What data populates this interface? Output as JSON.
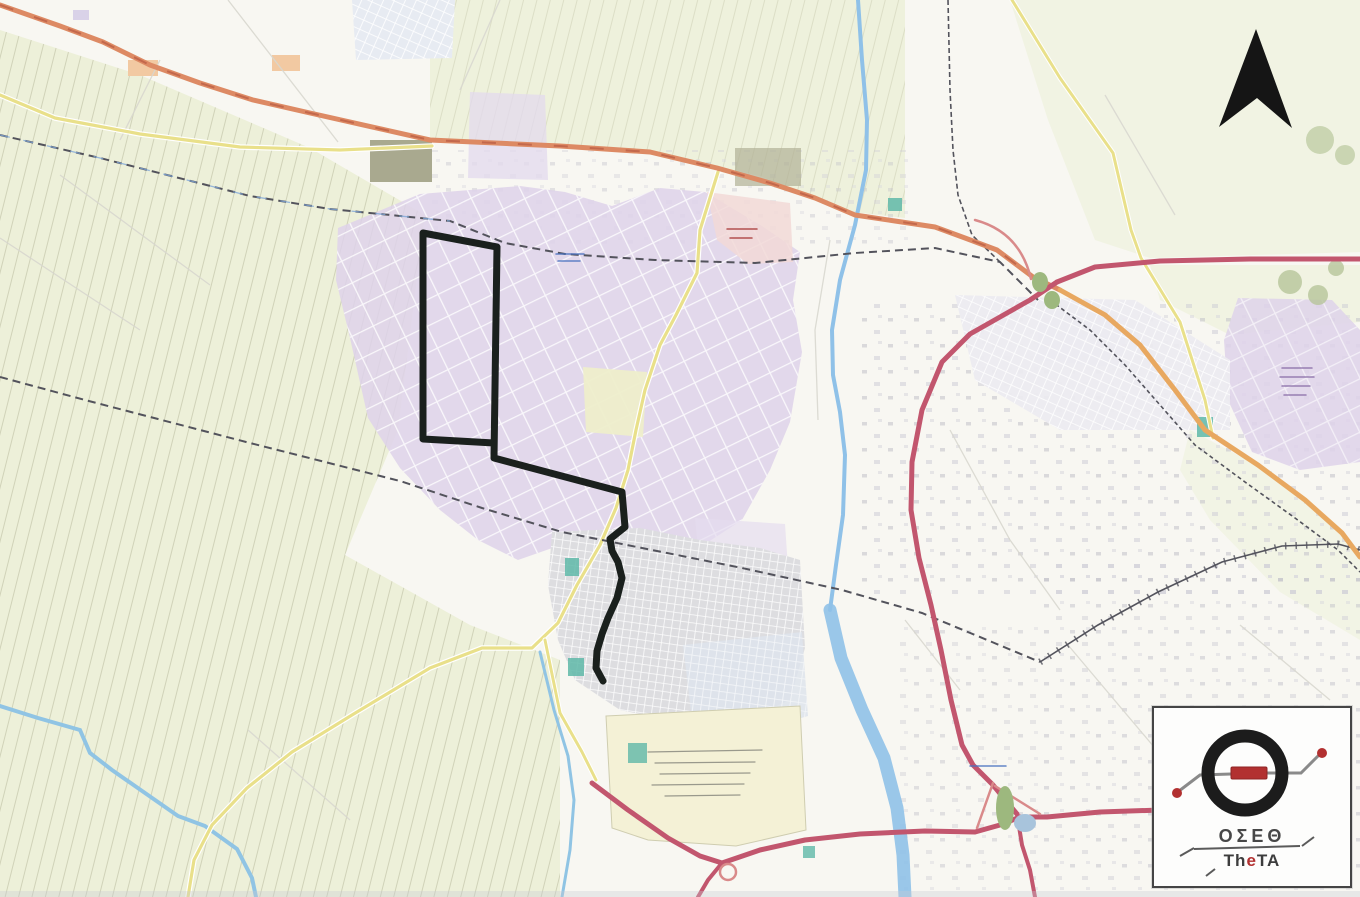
{
  "figure": {
    "kind": "scanned city map with highlighted transit route",
    "compass": {
      "north_arrow": "1256,29 1292,128 1257,98 1219,127"
    }
  },
  "logo": {
    "greek": "ΟΣΕΘ",
    "latin_pre": "Th",
    "latin_e": "e",
    "latin_post": "TA"
  },
  "colors": {
    "route_black": "#1a201d",
    "motorway_pink": "#c2566e",
    "highway_orange": "#dd8a64",
    "road_yellow": "#e9e08a",
    "railway_gray": "#53535c",
    "river_blue": "#8fc1e8",
    "fields_green": "#edf0d9",
    "industrial_purple": "#ded2ea",
    "town_gray": "#dddde0",
    "campus_yellow": "#f4f1d6",
    "pink_area": "#f2d9d7",
    "logo_red": "#b23030",
    "logo_black": "#1c1c1c"
  },
  "geo": {
    "route_line": "M423,233 L497,247 L494,458 L622,492 L625,527 L610,539 L612,551 L618,562 L622,578 L617,598 L608,618 L602,634 L597,651 L596,668 L603,681 M423,233 L423,439 L494,443",
    "orange_highway_nw": "M0,5 L60,26 L103,42 L150,65 L200,83 L253,100 L310,113 L430,140 L560,146 L650,152 L717,168 L770,183 L815,198 L855,215 L895,221 L935,227 L965,238 L997,250 L1033,277 L1060,290",
    "orange_road_se": "M1060,290 L1105,315 L1140,345 L1175,390 L1205,430 L1258,465 L1305,500 L1342,533 L1360,557",
    "motorway_east": "M1057,282 L1095,267 L1160,261 L1250,259 L1360,259",
    "motorway_arc": "M1057,282 L1030,300 L1000,317 L970,334 L942,362 L922,410 L912,462 L911,510 L919,558 L931,605 L941,650 L951,700 L962,745 L973,765 L993,785 L1007,802 L1017,814",
    "motorway_south": "M592,783 L628,810 L668,838 L700,856 L722,863 L760,850 L805,840 L860,834 L925,831 L975,832 L1000,825 L1020,817 L1047,817 L1100,812 L1160,810 L1205,806",
    "motorway_spur_s": "M722,863 L708,880 L698,897",
    "motorway_spur_se": "M1017,814 L1022,845 L1030,870 L1035,897",
    "ramp_arc_top": "M975,220 Q1020,232 1031,279",
    "ramp_lines_bottom": "M993,783 L977,828 M995,786 L1040,814",
    "railway_nw": "M0,135 L100,158 L250,196 L330,209 L450,221 L505,243 L565,254 L655,260 L755,263 L855,253 L935,248 L1000,262 L1038,300",
    "canal_overlay_nw": "M0,135 L100,158 L250,196 L330,209 L450,221",
    "railway_sw": "M0,377 L85,400 L250,443 L400,481 L482,508 L562,532 L642,548 L742,568 L842,590 L922,613 L992,642 L1040,662",
    "railway_loop": "M1040,662 L1098,625 L1158,592 L1222,562 L1282,546 L1338,544 L1360,550",
    "railway_n_vert": "M948,0 L950,90 L953,150 L958,195 L972,235 L1000,262",
    "railway_se_par": "M1050,300 L1090,330 L1125,365 L1160,405 L1195,445 L1245,482 L1295,518 L1338,550 L1360,572",
    "river_upper": "M858,0 L862,60 L867,120 L866,170 L855,225 L840,280 L832,330 L833,375 L840,412 L845,455 L843,515 L836,565 L830,610",
    "river_lower": "M830,610 L841,658 L862,710 L884,758 L897,808 L903,855 L905,897",
    "stream_sw": "M0,706 L38,718 L80,730 L90,753 L112,770 L145,793 L178,816 L205,826 L237,849 L252,878 L256,897",
    "stream_s": "M540,652 L554,710 L568,756 L574,800 L570,850 L562,897",
    "yellow_west": "M0,95 L55,118 L140,134 L240,147 L340,150 L432,146",
    "yellow_sw": "M718,172 L700,230 L697,273 L676,315 L660,345 L645,390 L636,430 L628,470 L616,508 L600,545 L577,585 L558,623 L532,648 L482,648 L430,668 L352,715 L292,752 L247,788 L212,825 L194,860 L188,897",
    "yellow_s": "M545,640 L560,713 L582,752 L596,780",
    "yellow_ne": "M1012,0 L1060,78 L1113,153 L1131,230 L1141,258 L1180,322 L1205,400 L1213,438"
  },
  "zones": {
    "fields_west": "0,30 140,75 310,148 425,215 398,430 345,555 470,625 560,660 560,897 0,897",
    "fields_north": "430,0 905,0 905,218 852,212 760,176 640,150 430,140",
    "fields_northeast": "1010,0 1360,0 1360,252 1150,258 1095,240 1048,120",
    "fields_east1": "1150,265 1360,265 1360,322 1230,335 1160,300",
    "fields_east2": "1190,430 1270,472 1330,520 1360,556 1360,640 1280,592 1210,520 1180,470",
    "industrial": "338,228 420,194 520,186 565,192 612,206 660,188 705,192 762,226 800,252 793,300 802,352 790,422 770,470 742,520 702,546 652,540 600,556 558,546 518,560 478,540 440,510 400,468 368,418 350,338 336,280",
    "industrial_patch_n": "470,92 545,95 548,180 468,178",
    "industrial_field": "583,367 647,372 643,437 586,432",
    "pink_area": "707,192 790,203 793,262 748,264 717,240",
    "purple_east": "1238,298 1332,300 1360,330 1360,462 1300,470 1252,452 1228,400 1224,340",
    "purple_mid": "1040,310 1128,316 1122,368 1036,360",
    "purple_town_ne": "695,518 785,524 788,568 700,570",
    "suburb": "955,295 1135,300 1230,360 1230,430 1060,430 975,380",
    "town": "552,532 640,528 700,540 760,548 800,560 805,648 790,700 740,722 680,722 620,710 575,680 558,640 548,585",
    "town_south": "683,645 802,632 808,716 760,730 692,720",
    "campus": "606,716 800,706 806,830 736,846 648,840 612,828",
    "grid_northwest": "352,0 455,0 452,58 356,60"
  }
}
